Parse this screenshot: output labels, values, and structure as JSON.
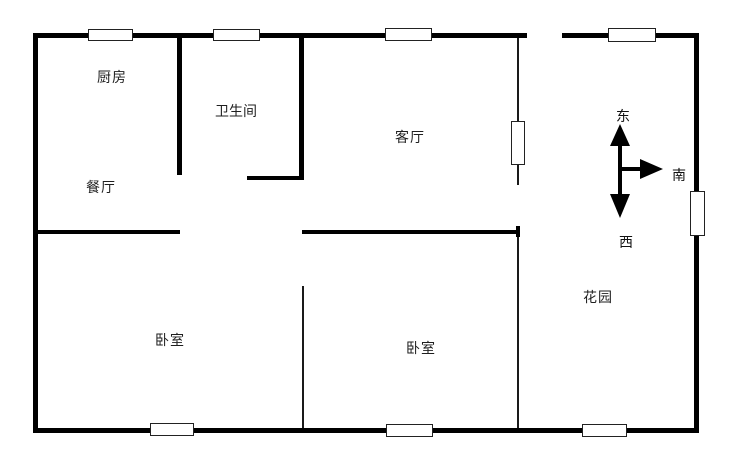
{
  "title": "apartment-floor-plan",
  "colors": {
    "background": "#ffffff",
    "wall": "#000000",
    "text": "#1f1f1f"
  },
  "rooms": [
    {
      "id": "kitchen",
      "label": "厨房"
    },
    {
      "id": "bathroom",
      "label": "卫生间"
    },
    {
      "id": "living-room",
      "label": "客厅"
    },
    {
      "id": "dining-room",
      "label": "餐厅"
    },
    {
      "id": "bedroom-left",
      "label": "卧室"
    },
    {
      "id": "bedroom-right",
      "label": "卧室"
    },
    {
      "id": "garden",
      "label": "花园"
    }
  ],
  "compass": {
    "east": "东",
    "south": "南",
    "west": "西"
  }
}
